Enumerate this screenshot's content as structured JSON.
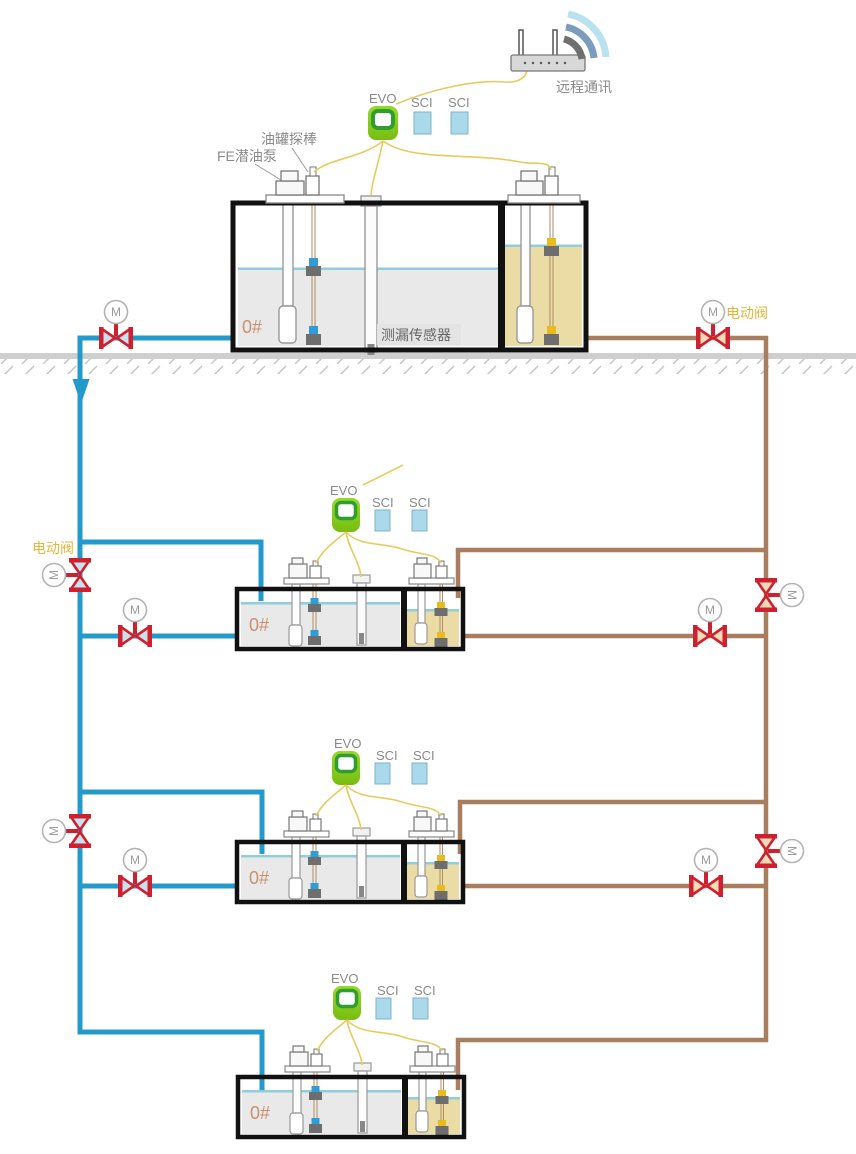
{
  "diagram": {
    "type": "fuel-tank-monitoring-schematic",
    "remote": {
      "label": "远程通讯",
      "router_icon": "wifi-router",
      "signal_icon": "wifi-arcs"
    },
    "labels": {
      "motor": "M",
      "electric_valve": "电动阀",
      "tank_probe": "油罐探棒",
      "submersible_pump": "FE潜油泵",
      "leak_sensor": "测漏传感器"
    },
    "stations": [
      {
        "controller": "EVO",
        "modules": [
          "SCI",
          "SCI"
        ],
        "fuel_grade": "0#"
      },
      {
        "controller": "EVO",
        "modules": [
          "SCI",
          "SCI"
        ],
        "fuel_grade": "0#"
      },
      {
        "controller": "EVO",
        "modules": [
          "SCI",
          "SCI"
        ],
        "fuel_grade": "0#"
      },
      {
        "controller": "EVO",
        "modules": [
          "SCI",
          "SCI"
        ],
        "fuel_grade": "0#"
      }
    ],
    "colors": {
      "pipe_blue": "#2499cb",
      "pipe_brown": "#a87e5e",
      "cable_yellow": "#e7cb5f",
      "valve_red": "#cf2030",
      "controller_green": "#8ed024",
      "module_blue": "#a9d9ea",
      "diesel_fluid": "#e9e9e9",
      "gasoline_fluid": "#ebdca6",
      "liquid_surface": "#8ecfdb",
      "ground_gray": "#cfcfcf",
      "valve_label_orange": "#e5b53a",
      "fuel_text": "#c9906e"
    }
  }
}
